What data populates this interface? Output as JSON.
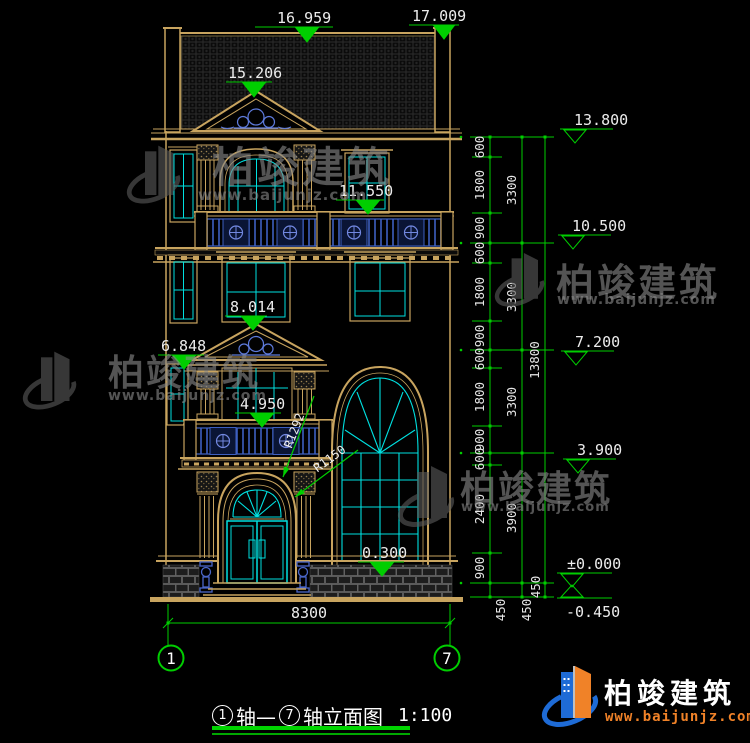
{
  "drawing": {
    "elevations_left": {
      "roof_mid": "16.959",
      "parapet": "17.009",
      "pediment": "15.206",
      "floor3": "11.550",
      "win2": "8.014",
      "band2": "6.848",
      "floor2": "4.950",
      "plinth": "0.300"
    },
    "elevations_right": {
      "l1": "13.800",
      "l2": "10.500",
      "l3": "7.200",
      "l4": "3.900",
      "l5": "±0.000",
      "l6": "-0.450"
    },
    "radii": {
      "outer": "R1292",
      "inner": "R1150"
    },
    "chain_inner": [
      "600",
      "1800",
      "900",
      "600",
      "1800",
      "900",
      "600",
      "1800",
      "900",
      "600",
      "2400",
      "900",
      "450"
    ],
    "chain_mid": [
      "3300",
      "3300",
      "3300",
      "3900",
      "450"
    ],
    "chain_outer": [
      "13800",
      "450"
    ],
    "overall_width": "8300",
    "axes": {
      "left": "1",
      "right": "7"
    }
  },
  "caption": {
    "axis_start": "1",
    "mid": "轴—",
    "axis_end": "7",
    "title": "轴立面图",
    "scale": "1:100"
  },
  "watermark": {
    "brand": "柏竣建筑",
    "url": "www.baijunjz.com"
  },
  "footer": {
    "brand": "柏竣建筑",
    "url": "www.baijunjz.com"
  },
  "colors": {
    "line_gold": "#c8a45f",
    "glass_cyan": "#00e0e0",
    "dim_green": "#00ce00",
    "rail_blue": "#3d5fc0",
    "brand_blue": "#1e6bd6",
    "brand_orange": "#f08228",
    "watermark_gray": "#5a5a5a"
  }
}
